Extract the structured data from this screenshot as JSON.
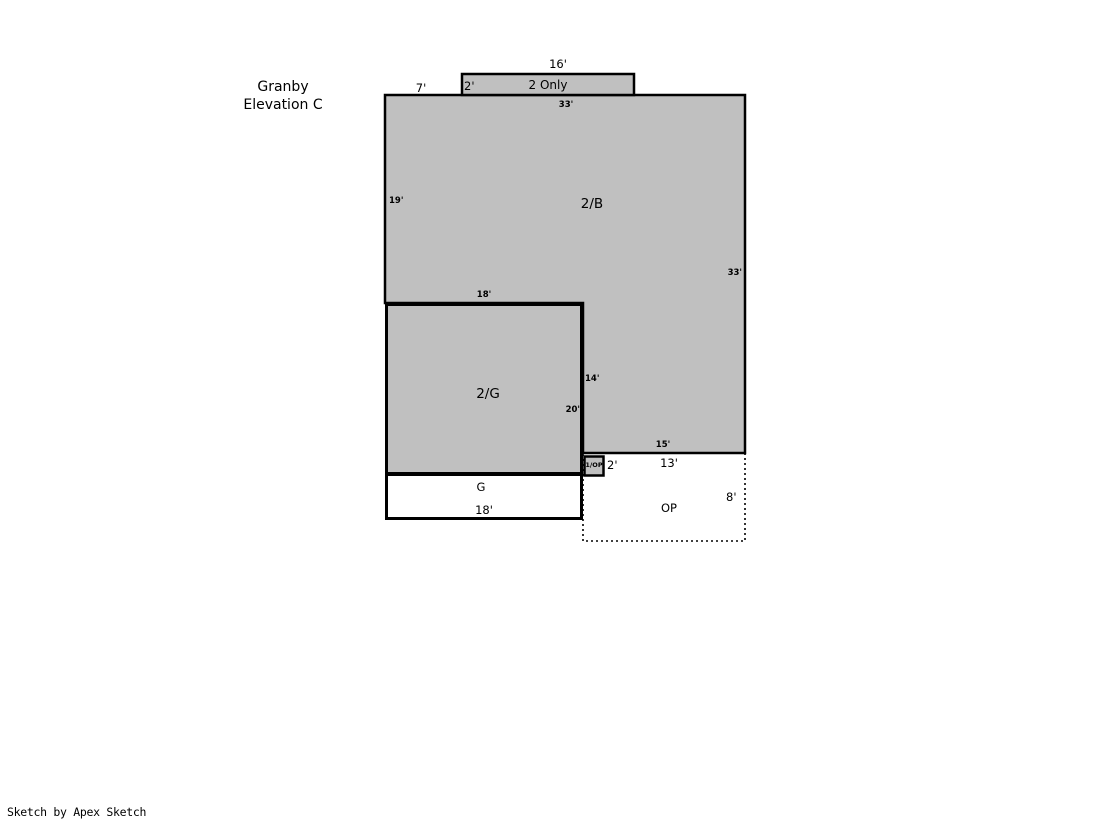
{
  "title": {
    "line1": "Granby",
    "line2": "Elevation C"
  },
  "footer": {
    "credit": "Sketch by Apex Sketch"
  },
  "areas": {
    "two_only": "2 Only",
    "second_b": "2/B",
    "second_g": "2/G",
    "garage": "G",
    "open_porch": "OP",
    "one_op": "1/OP"
  },
  "dims": {
    "top_box_width": "16'",
    "left_offset": "7'",
    "top_box_height": "2'",
    "main_top": "33'",
    "main_left": "19'",
    "main_right": "33'",
    "inner_top": "18'",
    "inner_wall_right": "14'",
    "inner_wall_left": "20'",
    "main_bottom": "15'",
    "porch_step": "2'",
    "porch_top": "13'",
    "porch_right": "8'",
    "garage_width": "18'"
  },
  "colors": {
    "fill": "#c0c0c0",
    "stroke": "#000000",
    "background": "#ffffff"
  }
}
